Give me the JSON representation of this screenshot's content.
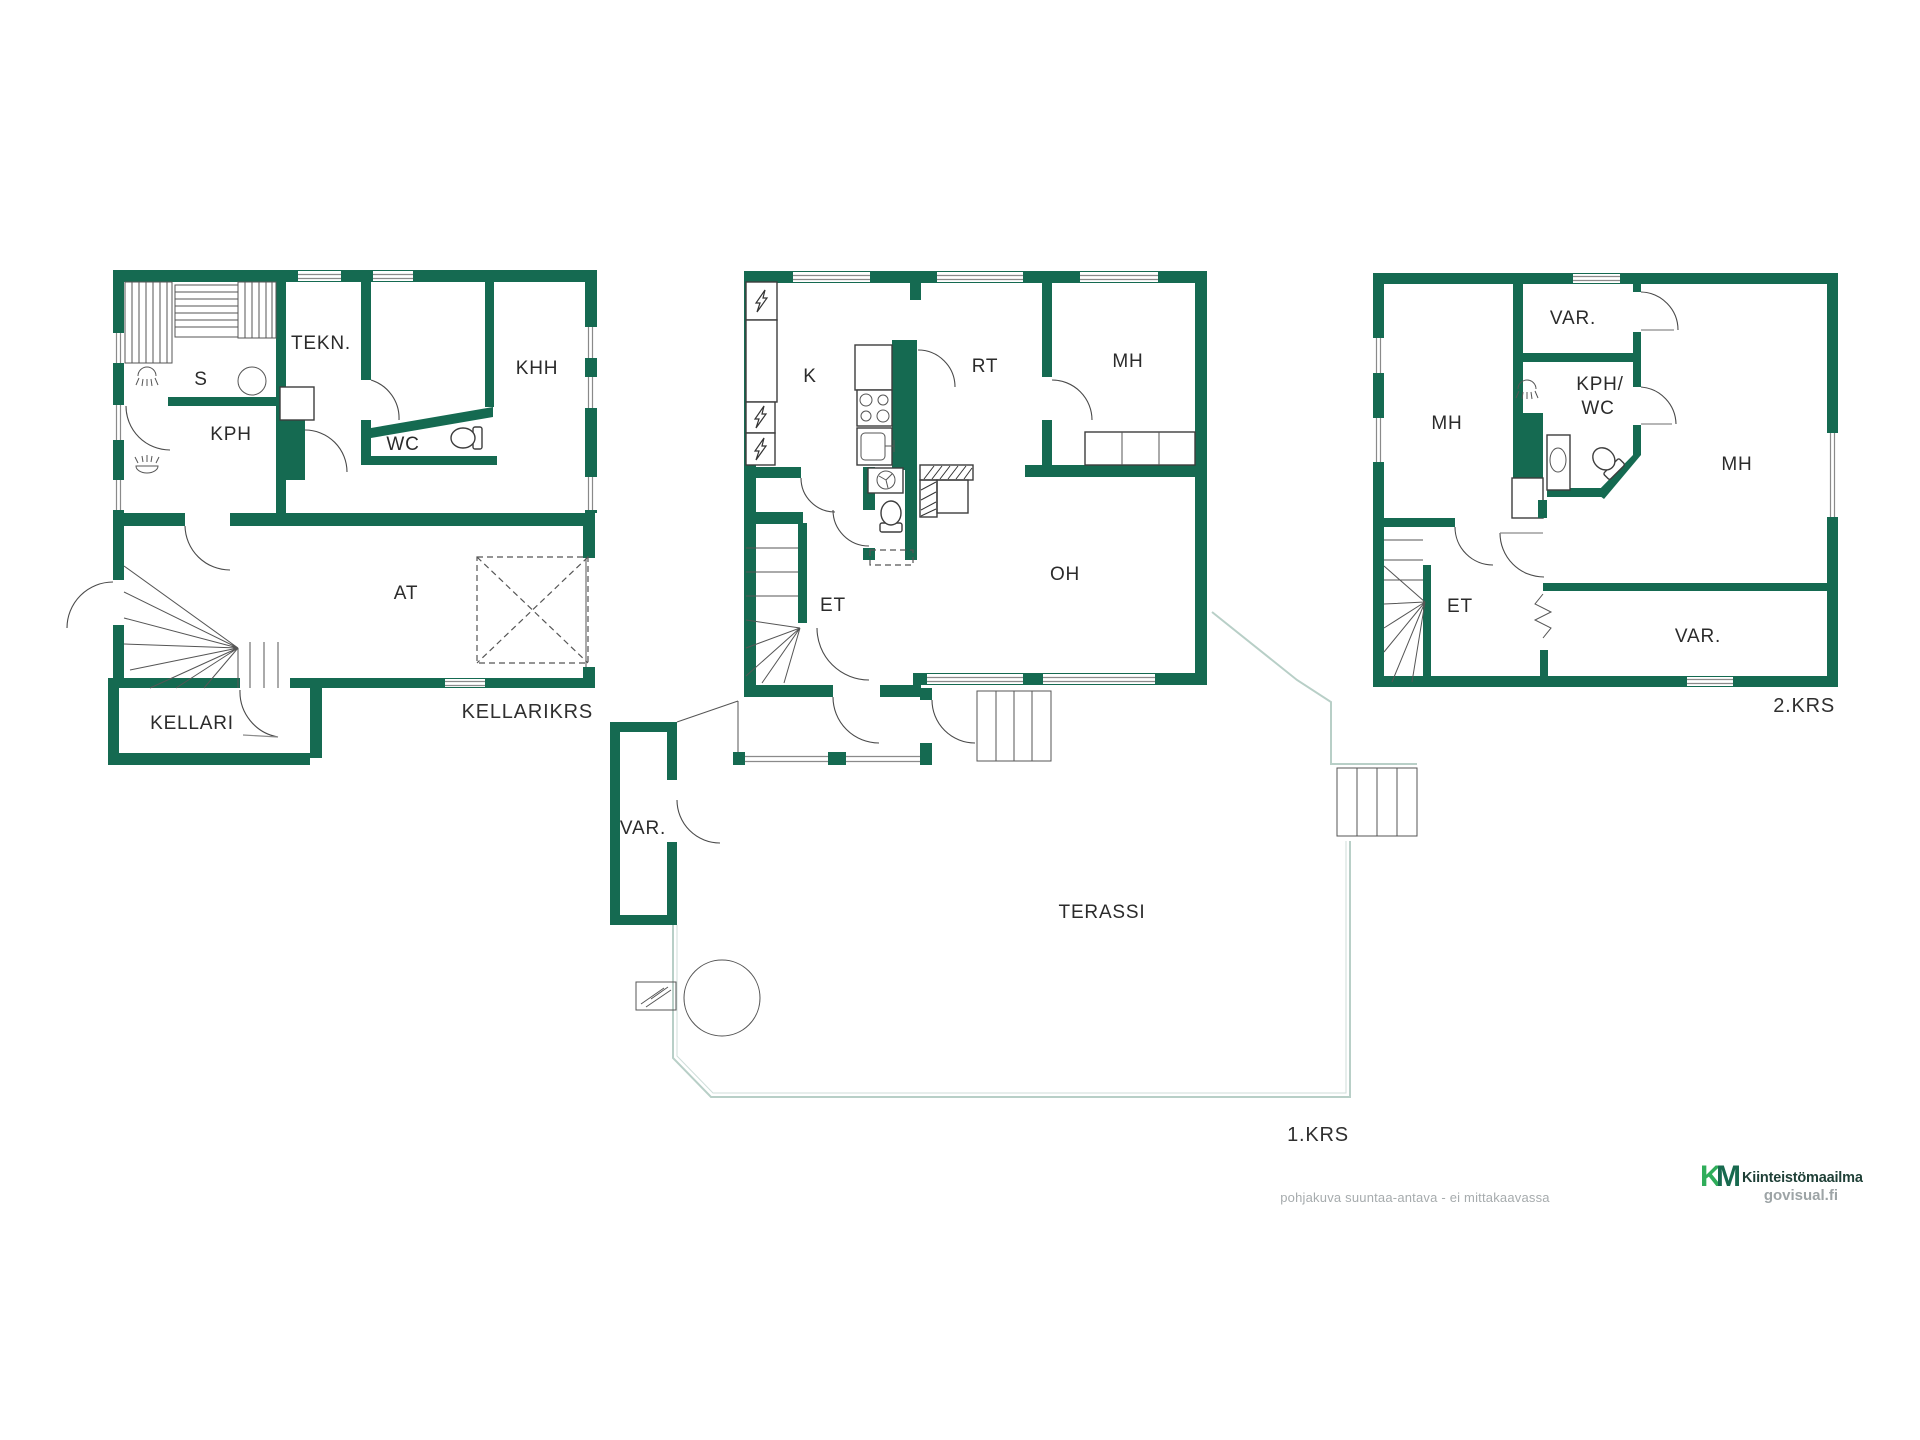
{
  "footer": {
    "disclaimer": "pohjakuva suuntaa-antava - ei mittakaavassa",
    "logo": {
      "k": "K",
      "m": "M",
      "wordmark": "Kiinteistömaailma",
      "site": "govisual.fi"
    }
  },
  "floors": {
    "basement": {
      "floor_label": "KELLARIKRS",
      "rooms": {
        "s": "S",
        "tekn": "TEKN.",
        "kph": "KPH",
        "wc": "WC",
        "khh": "KHH",
        "at": "AT",
        "kellari": "KELLARI"
      }
    },
    "first": {
      "floor_label": "1.KRS",
      "rooms": {
        "k": "K",
        "rt": "RT",
        "mh": "MH",
        "oh": "OH",
        "et": "ET",
        "var": "VAR.",
        "terassi": "TERASSI"
      }
    },
    "second": {
      "floor_label": "2.KRS",
      "rooms": {
        "var_top": "VAR.",
        "mh_west": "MH",
        "kph_wc_line1": "KPH/",
        "kph_wc_line2": "WC",
        "mh_east": "MH",
        "et": "ET",
        "var_south": "VAR."
      }
    }
  },
  "colors": {
    "wall": "#156a51",
    "terrace_outline": "#b8cfc7",
    "label_text": "#2b2b2b",
    "muted_text": "#a6abad",
    "logo_k": "#2fad5a",
    "logo_m": "#186a4f",
    "logo_wordmark": "#1e3f36"
  }
}
